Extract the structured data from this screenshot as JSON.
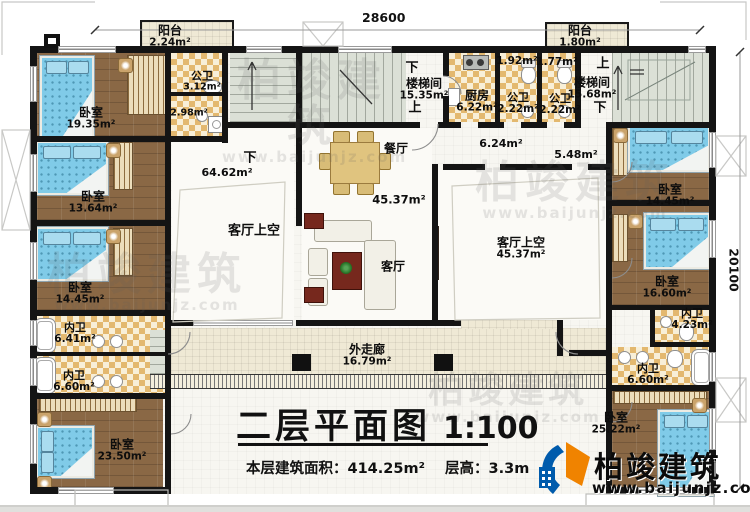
{
  "meta": {
    "title": "二层平面图",
    "scale": "1:100",
    "area_label": "本层建筑面积：",
    "area_value": "414.25m²",
    "height_label": "层高：",
    "height_value": "3.3m"
  },
  "dimensions": {
    "top": "28600",
    "right": "20100"
  },
  "brand": {
    "name": "柏竣建筑",
    "website": "www.baijunjz.com"
  },
  "watermark": {
    "text": "柏竣建筑",
    "url": "www.baijunjz.com"
  },
  "rooms": {
    "balcony_tl": {
      "name": "阳台",
      "area": "2.24m²"
    },
    "balcony_tr": {
      "name": "阳台",
      "area": "1.80m²"
    },
    "bedroom_tl": {
      "name": "卧室",
      "area": "19.35m²"
    },
    "bath_tl": {
      "name": "公卫",
      "area": "3.12m²"
    },
    "bath_tl_b": {
      "area": "2.98m²"
    },
    "stairs_left": {
      "name": "楼梯间",
      "area": "15.35m²",
      "up": "上",
      "down": "下"
    },
    "stairs_right": {
      "name": "楼梯间",
      "area": "15.68m²",
      "up": "上",
      "down": "下"
    },
    "kitchen": {
      "name": "厨房",
      "area": "6.22m²"
    },
    "bath_c1a": {
      "area": "1.92m²"
    },
    "bath_c1b": {
      "area": "1.77m²"
    },
    "bath_c1": {
      "name": "公卫",
      "area": "2.22m²"
    },
    "bath_c2": {
      "name": "公卫",
      "area": "2.22m²"
    },
    "hall_a": {
      "area": "6.24m²"
    },
    "hall_b": {
      "area": "5.48m²"
    },
    "dining": {
      "name": "餐厅"
    },
    "living": {
      "name": "客厅",
      "area": "45.37m²"
    },
    "void_left": {
      "name": "客厅上空",
      "area": "64.62m²",
      "down": "下"
    },
    "void_right": {
      "name": "客厅上空",
      "area": "45.37m²"
    },
    "bedroom_l2": {
      "name": "卧室",
      "area": "13.64m²"
    },
    "bedroom_l3": {
      "name": "卧室",
      "area": "14.45m²"
    },
    "bath_l1": {
      "name": "内卫",
      "area": "6.41m²"
    },
    "bath_l2": {
      "name": "内卫",
      "area": "6.60m²"
    },
    "bedroom_bl": {
      "name": "卧室",
      "area": "23.50m²"
    },
    "bedroom_r1": {
      "name": "卧室",
      "area": "14.45m²"
    },
    "bedroom_r2": {
      "name": "卧室",
      "area": "16.60m²"
    },
    "bath_r1": {
      "name": "内卫",
      "area": "4.23m²"
    },
    "bath_r2": {
      "name": "内卫",
      "area": "6.60m²"
    },
    "bedroom_br": {
      "name": "卧室",
      "area": "25.22m²"
    },
    "corridor": {
      "name": "外走廊",
      "area": "16.79m²"
    }
  },
  "colors": {
    "wall": "#141414",
    "wood_floor": "#8a6845",
    "tile": "#e3b86f",
    "stairs": "#dbe0d6",
    "deck": "#efe9d5",
    "bed": "#80cbe8",
    "logo_blue": "#005bac",
    "logo_orange": "#f08300"
  }
}
